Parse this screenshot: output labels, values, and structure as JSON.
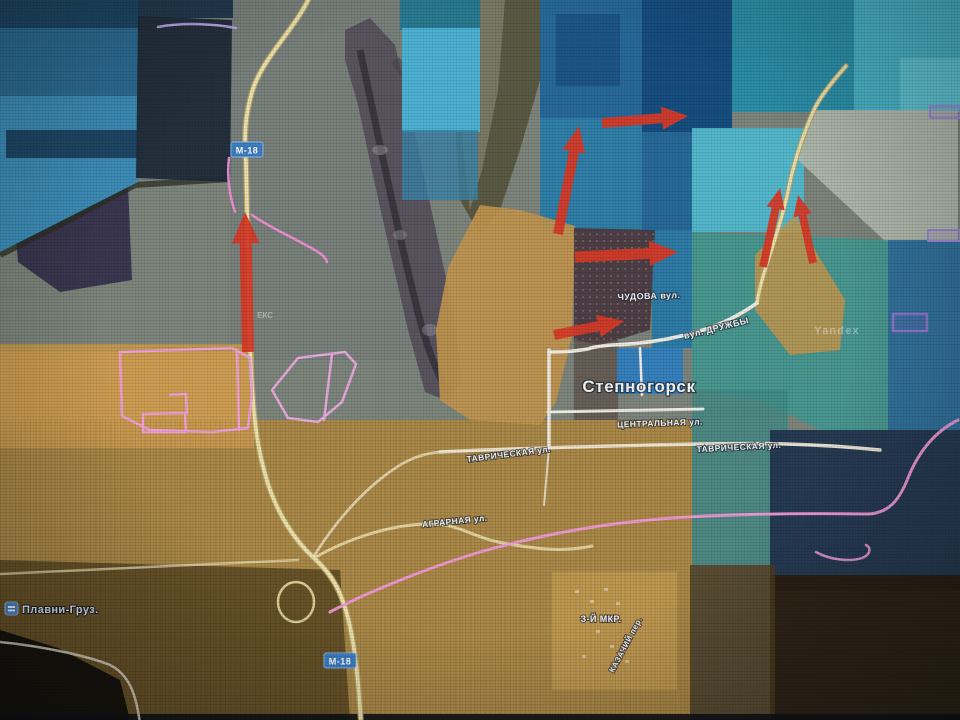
{
  "map": {
    "description": "satellite-map-with-control-zones-and-advance-arrows",
    "colors": {
      "arrow_red": "#d63b28",
      "zone_blue": "#3e8fba",
      "zone_tan": "#c2964e",
      "road_yellow": "#eee2ac",
      "road_white": "#efece4",
      "boundary_pink": "#f09ad6",
      "badge_blue": "#3e7ec2"
    },
    "badges": [
      {
        "text": "М-18",
        "x": 247,
        "y": 150
      },
      {
        "text": "М-18",
        "x": 340,
        "y": 661
      }
    ],
    "labels": [
      {
        "text": "ЧУДОВА вул.",
        "x": 649,
        "y": 299,
        "rot": -2,
        "size": 9,
        "cls": "lbl",
        "name": "street-label-chudova"
      },
      {
        "text": "вул. ДРУЖБЫ",
        "x": 717,
        "y": 331,
        "rot": -14,
        "size": 9,
        "cls": "lbl",
        "name": "street-label-druzhby"
      },
      {
        "text": "Степногорск",
        "x": 639,
        "y": 392,
        "rot": 0,
        "size": 17,
        "cls": "lbl town",
        "name": "town-label-stepnogorsk"
      },
      {
        "text": "ЦЕНТРАЛЬНАЯ ул.",
        "x": 660,
        "y": 426,
        "rot": -2,
        "size": 8.5,
        "cls": "lbl",
        "name": "street-label-tsentralnaya"
      },
      {
        "text": "ТАВРИЧЕСКАЯ ул.",
        "x": 739,
        "y": 450,
        "rot": -3,
        "size": 8.5,
        "cls": "lbl",
        "name": "street-label-tavricheskaya-east"
      },
      {
        "text": "ТАВРИЧЕСКАЯ ул.",
        "x": 509,
        "y": 457,
        "rot": -7,
        "size": 8.5,
        "cls": "lbl",
        "name": "street-label-tavricheskaya-west"
      },
      {
        "text": "АГРАРНАЯ ул.",
        "x": 455,
        "y": 524,
        "rot": -6,
        "size": 8.5,
        "cls": "lbl",
        "name": "street-label-agrarnaya"
      },
      {
        "text": "З-Й МКР.",
        "x": 601,
        "y": 622,
        "rot": 0,
        "size": 9,
        "cls": "lbl",
        "name": "district-label-3rd-mkr"
      },
      {
        "text": "КАЗАЧИЙ пер.",
        "x": 628,
        "y": 646,
        "rot": -62,
        "size": 8,
        "cls": "lbl",
        "name": "street-label-kazachiy"
      },
      {
        "text": "Плавни-Груз.",
        "x": 22,
        "y": 613,
        "rot": 0,
        "size": 11,
        "cls": "lbl place",
        "anchor": "start",
        "name": "place-label-plavni-gruz"
      },
      {
        "text": "Yandex",
        "x": 837,
        "y": 334,
        "rot": 0,
        "size": 11,
        "cls": "watermark",
        "name": "yandex-watermark"
      },
      {
        "text": "ЕКС",
        "x": 265,
        "y": 318,
        "rot": 0,
        "size": 8,
        "cls": "faint",
        "name": "faint-partial-label"
      }
    ],
    "arrows": [
      {
        "x1": 248,
        "y1": 352,
        "x2": 245,
        "y2": 212,
        "w": 12
      },
      {
        "x1": 558,
        "y1": 234,
        "x2": 579,
        "y2": 126,
        "w": 10
      },
      {
        "x1": 602,
        "y1": 123,
        "x2": 688,
        "y2": 116,
        "w": 10
      },
      {
        "x1": 575,
        "y1": 257,
        "x2": 678,
        "y2": 252,
        "w": 11
      },
      {
        "x1": 554,
        "y1": 335,
        "x2": 624,
        "y2": 321,
        "w": 10
      },
      {
        "x1": 763,
        "y1": 267,
        "x2": 780,
        "y2": 188,
        "w": 8
      },
      {
        "x1": 813,
        "y1": 263,
        "x2": 798,
        "y2": 195,
        "w": 8
      }
    ]
  }
}
